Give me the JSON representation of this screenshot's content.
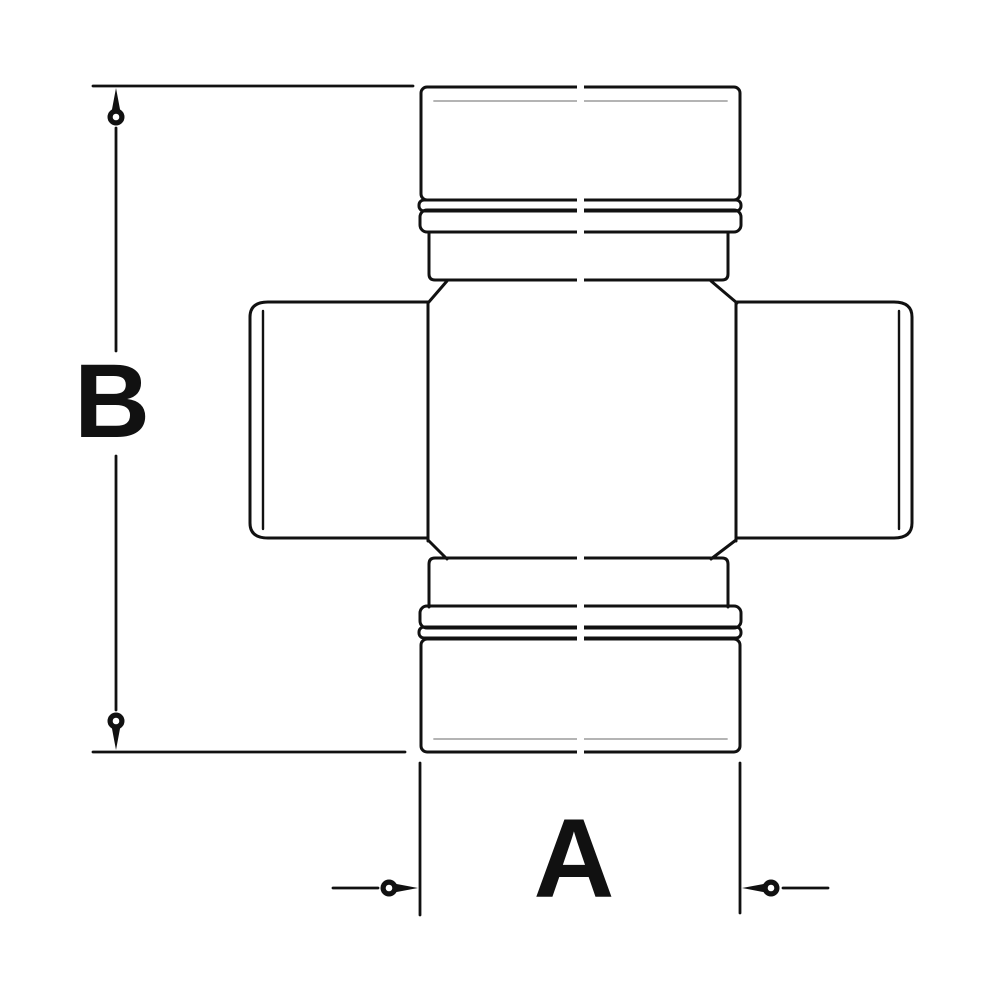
{
  "diagram": {
    "type": "technical-drawing",
    "subject": "universal-joint-cross-journal",
    "background_color": "#ffffff",
    "line_color": "#111111",
    "dimensions": {
      "vertical": {
        "label": "B"
      },
      "horizontal": {
        "label": "A"
      }
    }
  }
}
